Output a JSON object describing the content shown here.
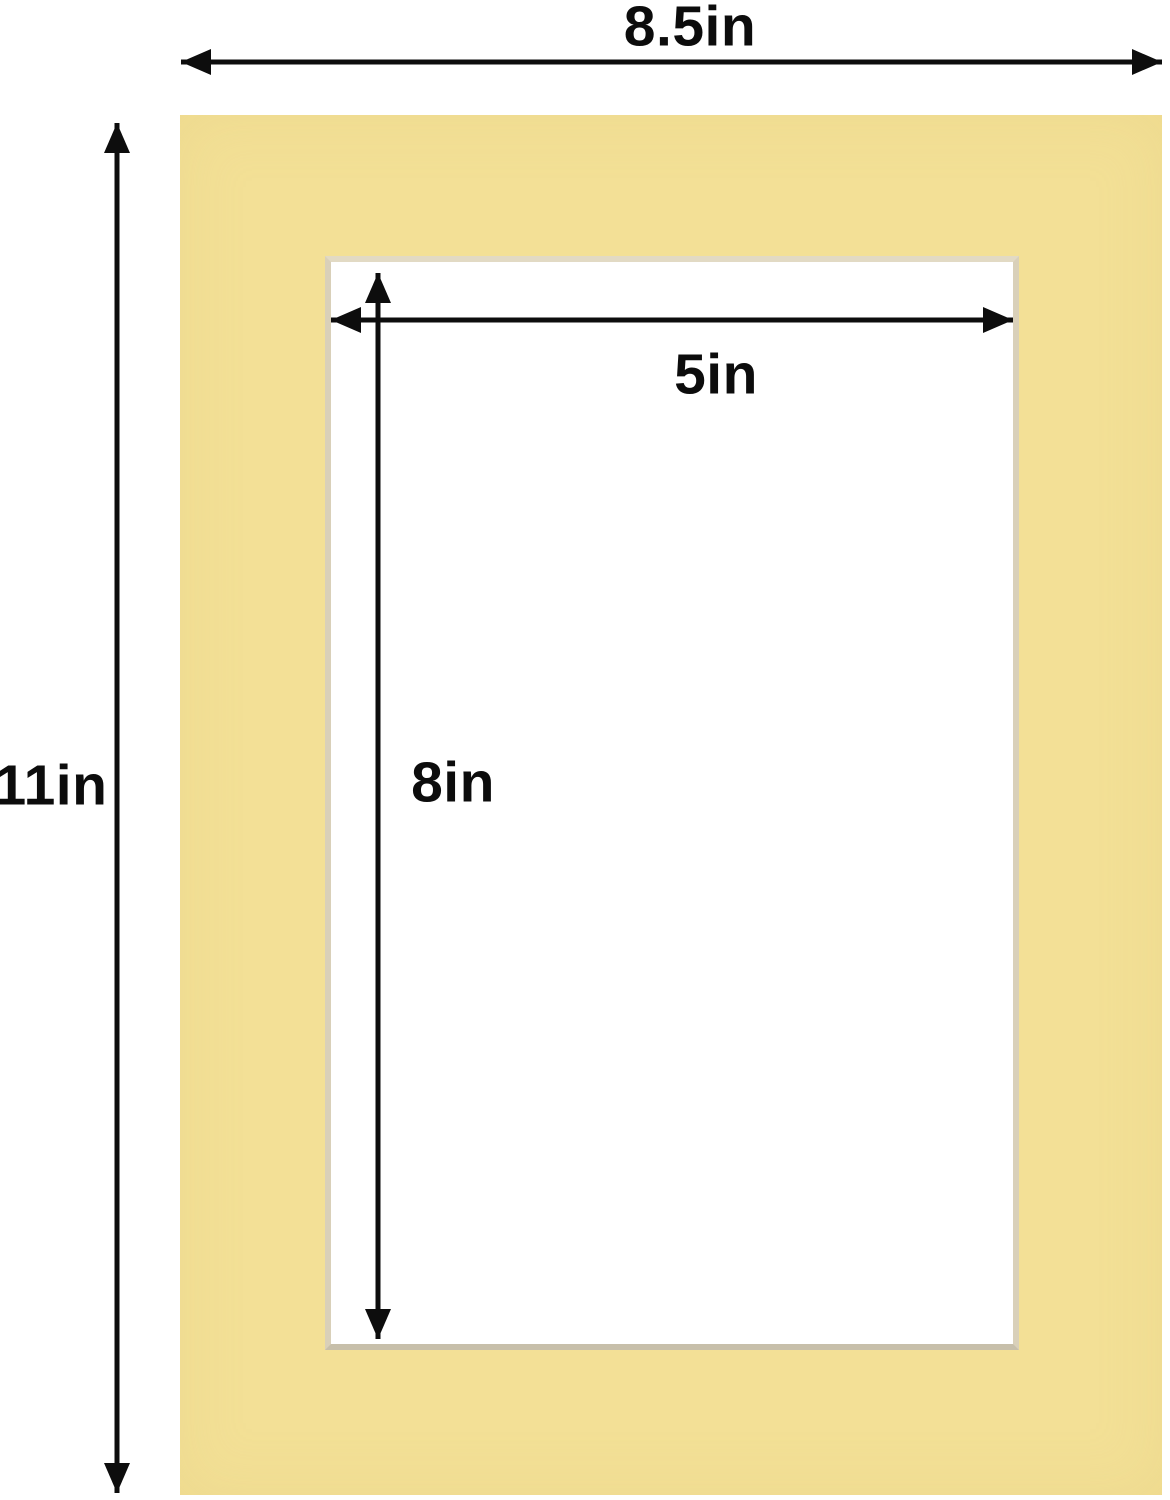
{
  "diagram": {
    "type": "picture-mat-dimension-diagram",
    "description": "Yellow picture mat board with rectangular window opening and dimension arrows",
    "outer_width": "8.5in",
    "outer_height": "11in",
    "window_width": "5in",
    "window_height": "8in",
    "colors": {
      "mat": "#f3e096",
      "bevel_edge": "#d9d0b9",
      "arrow": "#0d0d0d",
      "background": "#ffffff"
    }
  }
}
